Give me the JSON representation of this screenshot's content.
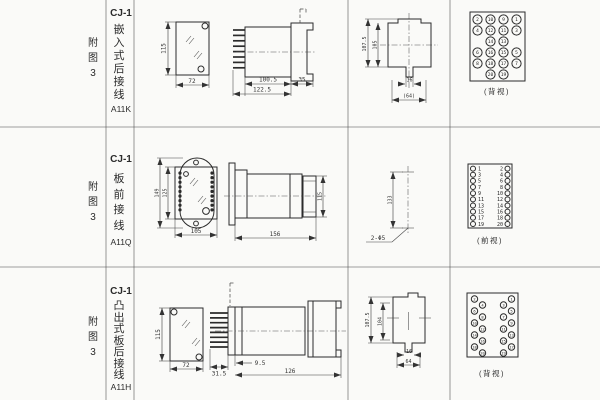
{
  "colors": {
    "line": "#2b2b2b",
    "dim_text": "#333333",
    "background": "#fafaf8"
  },
  "rows": [
    {
      "fig_label": "附图3",
      "type_label": "CJ-1",
      "mount_label": "嵌入式后接线",
      "model": "A11K",
      "dims": {
        "front_h": "115",
        "front_w": "72",
        "body_l": "100.5",
        "total_l": "122.5",
        "flange_d": "35",
        "cut_h": "107.5",
        "cut_h2": "105",
        "notch_w": "16",
        "hole_span": "(64)"
      },
      "terminal_caption": "(背视)",
      "terminals": {
        "view": "grid",
        "rows": [
          [
            "2",
            "10",
            "9",
            "1"
          ],
          [
            "4",
            "12",
            "11",
            "3"
          ],
          [
            null,
            "14",
            "13",
            null
          ],
          [
            "6",
            "16",
            "15",
            "5"
          ],
          [
            "8",
            "18",
            "17",
            "7"
          ],
          [
            null,
            "20",
            "19",
            null
          ]
        ]
      }
    },
    {
      "fig_label": "附图3",
      "type_label": "CJ-1",
      "mount_label": "板前接线",
      "model": "A11Q",
      "dims": {
        "plate_h": "149",
        "case_h": "125",
        "case_w": "105",
        "side_l": "156",
        "side_h": "115",
        "hole_span": "133",
        "holes": "2-Φ5"
      },
      "terminal_caption": "(前视)",
      "terminals": {
        "view": "columns",
        "left": [
          "1",
          "3",
          "5",
          "7",
          "9",
          "11",
          "13",
          "15",
          "17",
          "19"
        ],
        "right": [
          "2",
          "4",
          "6",
          "8",
          "10",
          "12",
          "14",
          "16",
          "18",
          "20"
        ]
      }
    },
    {
      "fig_label": "附图3",
      "type_label": "CJ-1",
      "mount_label": "凸出式板后接线",
      "model": "A11H",
      "dims": {
        "front_h": "115",
        "front_w": "72",
        "term_l": "31.5",
        "gap": "9.5",
        "body_l": "126",
        "cut_h": "107.5",
        "cut_h2": "104",
        "notch_w": "16",
        "hole_span": "64"
      },
      "terminal_caption": "(背视)",
      "terminals": {
        "view": "zigzag",
        "left": [
          "2",
          "4",
          "6",
          "8",
          "10",
          "12",
          "14",
          "16",
          "18",
          "20"
        ],
        "right": [
          "1",
          "3",
          "5",
          "7",
          "9",
          "11",
          "13",
          "15",
          "17",
          "19"
        ]
      }
    }
  ]
}
